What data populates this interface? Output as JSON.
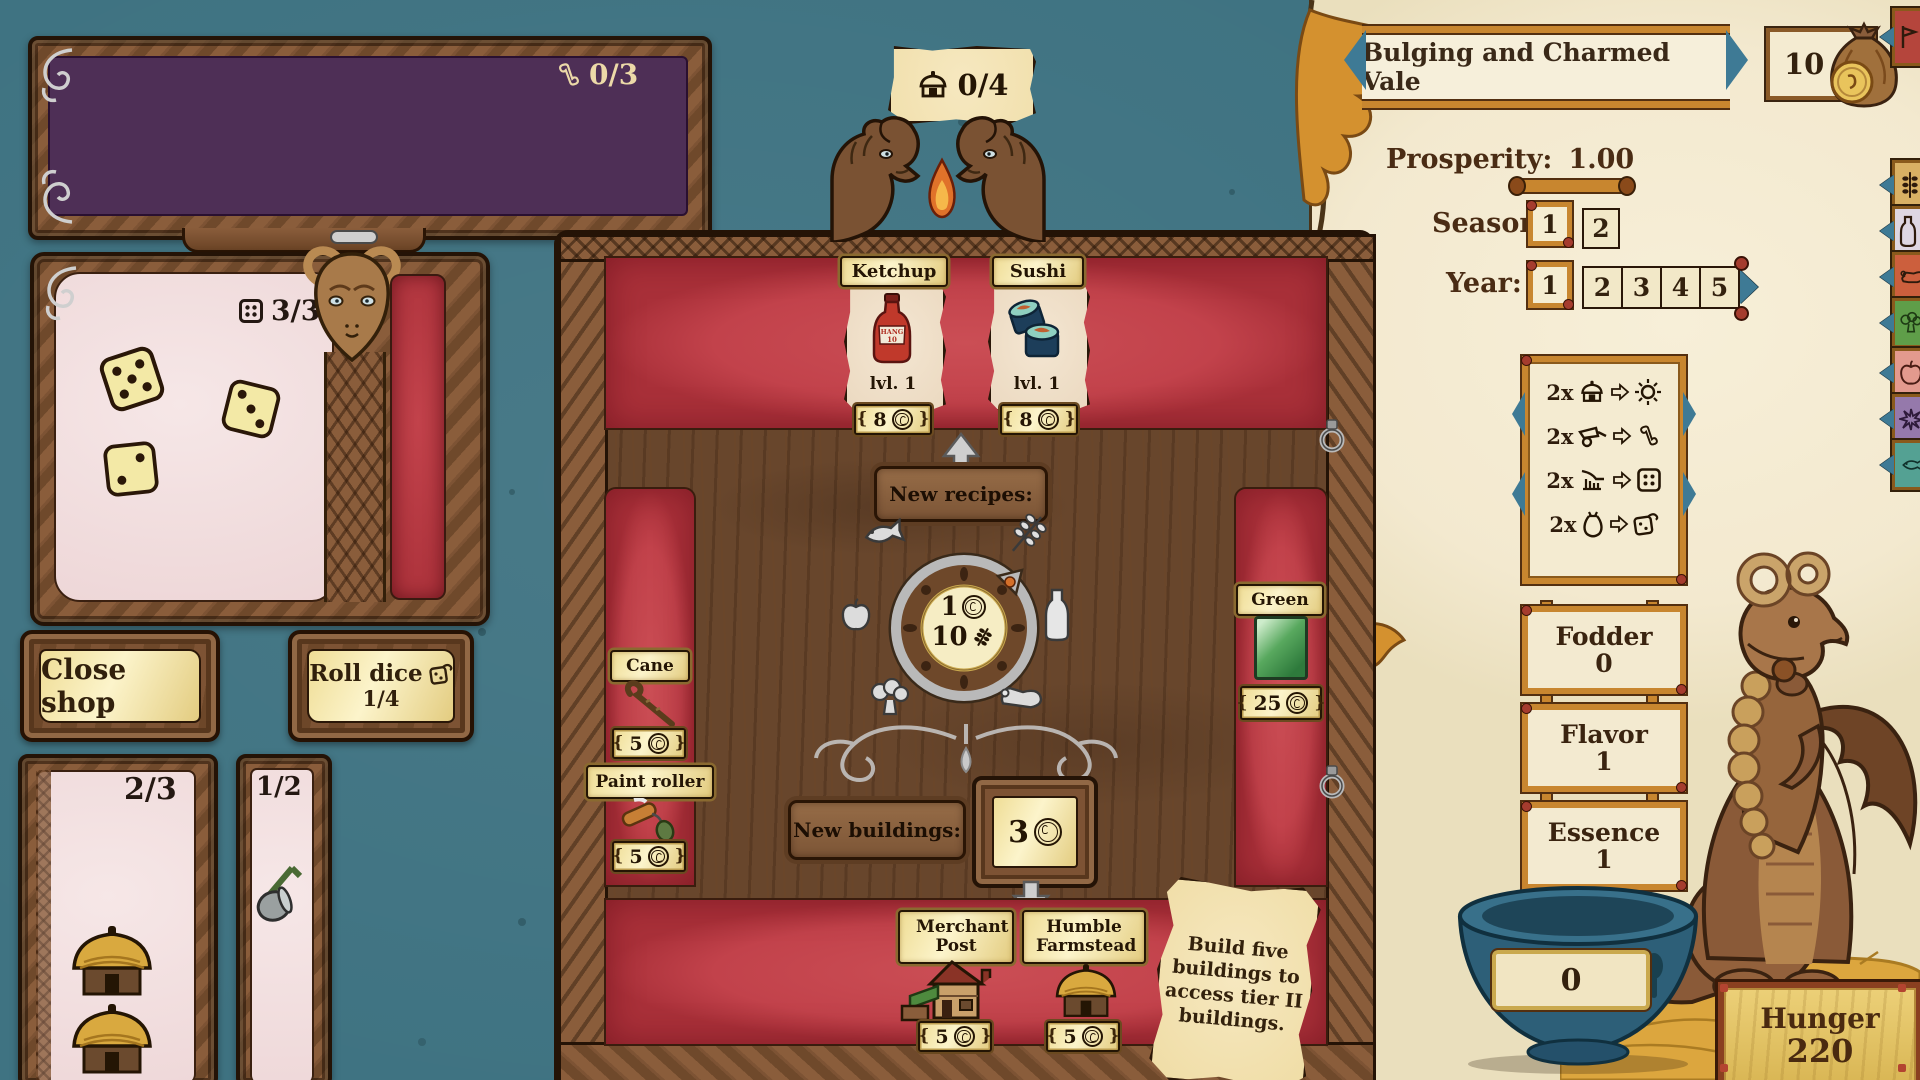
{
  "colors": {
    "teal_bg": "#3f7382",
    "parchment": "#f3e9cf",
    "wood": "#68462c",
    "red_band": "#c2424b",
    "gold": "#f2e2a0",
    "purple": "#4e2f56",
    "pink": "#eed7d8",
    "accent_gold": "#d4912f",
    "bowl_blue": "#2d5f78",
    "hunger_gold": "#e3c06b"
  },
  "top_left_panel": {
    "recipes_counter": "0/3"
  },
  "dice_panel": {
    "counter": "3/3",
    "dice_values": [
      5,
      3,
      2
    ]
  },
  "buttons": {
    "close_shop": "Close shop",
    "roll_dice": "Roll dice",
    "roll_dice_count": "1/4"
  },
  "hand": {
    "buildings_card_count": "2/3",
    "tools_card_count": "1/2"
  },
  "board": {
    "buildings_banner_count": "0/4",
    "recipe_cards": [
      {
        "name": "Ketchup",
        "level": "lvl. 1",
        "price": "8",
        "bottle_label": "HANG 10"
      },
      {
        "name": "Sushi",
        "level": "lvl. 1",
        "price": "8"
      }
    ],
    "new_recipes_label": "New recipes:",
    "wheel": {
      "coin_cost": "1",
      "wheat_cost": "10"
    },
    "shop_items": [
      {
        "name": "Cane",
        "price": "5"
      },
      {
        "name": "Paint roller",
        "price": "5"
      }
    ],
    "paint_item": {
      "name": "Green",
      "price": "25"
    },
    "new_buildings_label": "New buildings:",
    "building_slot_price": "3",
    "building_cards": [
      {
        "name": "Merchant Post",
        "price": "5"
      },
      {
        "name": "Humble Farmstead",
        "price": "5"
      }
    ],
    "note_lines": [
      "Build five",
      "buildings to",
      "access tier II",
      "buildings."
    ]
  },
  "right_panel": {
    "title": "Bulging and Charmed Vale",
    "money": "10",
    "prosperity_label": "Prosperity:",
    "prosperity_value": "1.00",
    "season_label": "Season:",
    "seasons": [
      "1",
      "2"
    ],
    "year_label": "Year:",
    "years": [
      "1",
      "2",
      "3",
      "4",
      "5"
    ],
    "conversions": [
      {
        "qty": "2x",
        "from": "hut",
        "to": "sun"
      },
      {
        "qty": "2x",
        "from": "cart",
        "to": "scroll"
      },
      {
        "qty": "2x",
        "from": "plow",
        "to": "dice-face"
      },
      {
        "qty": "2x",
        "from": "sack",
        "to": "roll-die"
      }
    ],
    "stats": [
      {
        "label": "Fodder",
        "value": "0"
      },
      {
        "label": "Flavor",
        "value": "1"
      },
      {
        "label": "Essence",
        "value": "1"
      }
    ],
    "bowl_value": "0",
    "hunger": {
      "label": "Hunger",
      "value": "220"
    }
  }
}
